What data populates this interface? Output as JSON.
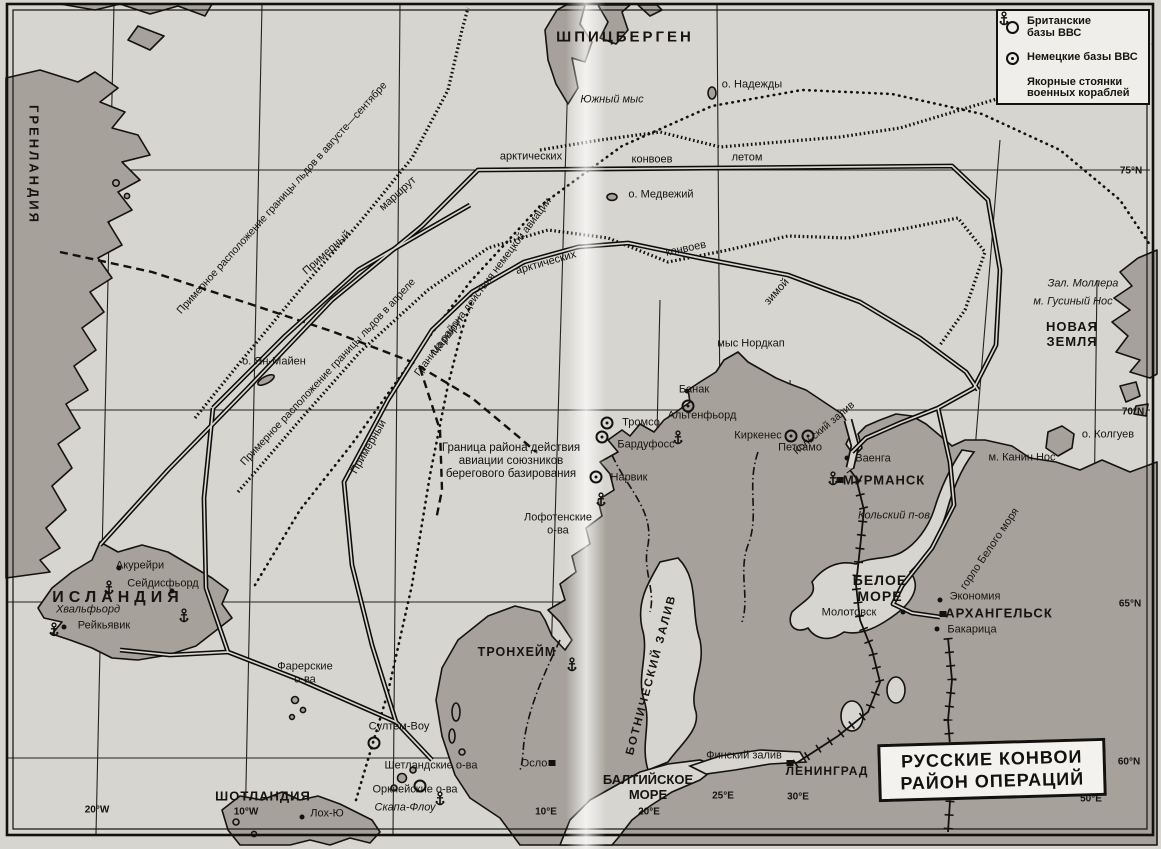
{
  "map": {
    "title_box": {
      "line1": "РУССКИЕ КОНВОИ",
      "line2": "РАЙОН ОПЕРАЦИЙ"
    },
    "legend": {
      "items": [
        {
          "name": "legend-british-bases",
          "symbol": "british-base-icon",
          "label": "Британские\nбазы ВВС"
        },
        {
          "name": "legend-german-bases",
          "symbol": "german-base-icon",
          "label": "Немецкие базы ВВС"
        },
        {
          "name": "legend-anchorages",
          "symbol": "anchor-icon",
          "label": "Якорные стоянки\nвоенных кораблей"
        }
      ]
    },
    "colors": {
      "sea": "#d7d5d0",
      "land": "#a6a29b",
      "ink": "#131110",
      "box_bg": "#f3f2ee"
    },
    "graticule": [
      {
        "name": "lat-75n",
        "text": "75°N",
        "x": 1131,
        "y": 171
      },
      {
        "name": "lat-70n",
        "text": "70°N",
        "x": 1133,
        "y": 412
      },
      {
        "name": "lat-65n",
        "text": "65°N",
        "x": 1130,
        "y": 604
      },
      {
        "name": "lat-60n",
        "text": "60°N",
        "x": 1129,
        "y": 762
      },
      {
        "name": "lon-20w",
        "text": "20°W",
        "x": 97,
        "y": 810
      },
      {
        "name": "lon-10w",
        "text": "10°W",
        "x": 246,
        "y": 812
      },
      {
        "name": "lon-10e",
        "text": "10°E",
        "x": 546,
        "y": 812
      },
      {
        "name": "lon-20e",
        "text": "20°E",
        "x": 649,
        "y": 812
      },
      {
        "name": "lon-25e",
        "text": "25°E",
        "x": 723,
        "y": 796
      },
      {
        "name": "lon-30e",
        "text": "30°E",
        "x": 798,
        "y": 797
      },
      {
        "name": "lon-40e",
        "text": "40°E",
        "x": 944,
        "y": 797
      },
      {
        "name": "lon-50e",
        "text": "50°E",
        "x": 1091,
        "y": 799
      }
    ],
    "labels": [
      {
        "name": "greenland",
        "text": "ГРЕНЛАНДИЯ",
        "x": 33,
        "y": 165,
        "rot": 90,
        "cls": "region",
        "size": 13,
        "sp": 3
      },
      {
        "name": "spitsbergen",
        "text": "ШПИЦБЕРГЕН",
        "x": 625,
        "y": 37,
        "cls": "region",
        "size": 15,
        "sp": 3
      },
      {
        "name": "iceland",
        "text": "ИСЛАНДИЯ",
        "x": 118,
        "y": 598,
        "cls": "region",
        "size": 16,
        "sp": 5
      },
      {
        "name": "novaya-zemlya",
        "text": "НОВАЯ\nЗЕМЛЯ",
        "x": 1072,
        "y": 335,
        "cls": "region",
        "size": 13,
        "sp": 1
      },
      {
        "name": "white-sea",
        "text": "БЕЛОЕ\nМОРЕ",
        "x": 880,
        "y": 588,
        "cls": "region",
        "size": 14,
        "sp": 1
      },
      {
        "name": "baltic-sea",
        "text": "БАЛТИЙСКОЕ\nМОРЕ",
        "x": 648,
        "y": 788,
        "cls": "region",
        "size": 13
      },
      {
        "name": "scotland",
        "text": "ШОТЛАНДИЯ",
        "x": 263,
        "y": 797,
        "cls": "region",
        "size": 13,
        "sp": 1
      },
      {
        "name": "gulf-of-bothnia",
        "text": "БОТНИЧЕСКИЙ ЗАЛИВ",
        "x": 652,
        "y": 675,
        "rot": -75,
        "cls": "region",
        "size": 11.5,
        "sp": 2
      },
      {
        "name": "murmansk",
        "text": "МУРМАНСК",
        "x": 884,
        "y": 481,
        "cls": "city-major",
        "size": 13
      },
      {
        "name": "arkhangelsk",
        "text": "АРХАНГЕЛЬСК",
        "x": 999,
        "y": 614,
        "cls": "city-major",
        "size": 13
      },
      {
        "name": "leningrad",
        "text": "ЛЕНИНГРАД",
        "x": 827,
        "y": 772,
        "cls": "city-major",
        "size": 12
      },
      {
        "name": "trondheim",
        "text": "ТРОНХЕЙМ",
        "x": 517,
        "y": 652,
        "cls": "city-major",
        "size": 12.5
      },
      {
        "name": "akureyri",
        "text": "Акурейри",
        "x": 140,
        "y": 566
      },
      {
        "name": "seydisfjord",
        "text": "Сейдисфьорд",
        "x": 163,
        "y": 584
      },
      {
        "name": "reykjavik",
        "text": "Рейкьявик",
        "x": 104,
        "y": 626
      },
      {
        "name": "hvalfjord",
        "text": "Хвальфьорд",
        "x": 88,
        "y": 610,
        "cls": "italic"
      },
      {
        "name": "tromso",
        "text": "Тромсо",
        "x": 641,
        "y": 423
      },
      {
        "name": "bardufoss",
        "text": "Бардуфосс",
        "x": 646,
        "y": 445
      },
      {
        "name": "banak",
        "text": "Банак",
        "x": 694,
        "y": 390
      },
      {
        "name": "altenfjord",
        "text": "Альтенфьорд",
        "x": 702,
        "y": 416
      },
      {
        "name": "nordkap",
        "text": "мыс Нордкап",
        "x": 751,
        "y": 344
      },
      {
        "name": "kirkenes",
        "text": "Киркенес",
        "x": 758,
        "y": 436
      },
      {
        "name": "petsamo",
        "text": "Петсамо",
        "x": 800,
        "y": 448
      },
      {
        "name": "vaenga",
        "text": "Ваенга",
        "x": 873,
        "y": 459
      },
      {
        "name": "narvik",
        "text": "Нарвик",
        "x": 629,
        "y": 478
      },
      {
        "name": "lofoten",
        "text": "Лофотенские\nо-ва",
        "x": 558,
        "y": 524
      },
      {
        "name": "oslo",
        "text": "Осло",
        "x": 534,
        "y": 764
      },
      {
        "name": "molotovsk",
        "text": "Молотовск",
        "x": 849,
        "y": 613
      },
      {
        "name": "ekonomiya",
        "text": "Экономия",
        "x": 975,
        "y": 597
      },
      {
        "name": "bakaritsa",
        "text": "Бакарица",
        "x": 972,
        "y": 630
      },
      {
        "name": "finnish-gulf",
        "text": "Финский залив",
        "x": 744,
        "y": 756
      },
      {
        "name": "kanin-nos",
        "text": "м. Канин Нос",
        "x": 1022,
        "y": 458
      },
      {
        "name": "kolguev",
        "text": "о. Колгуев",
        "x": 1108,
        "y": 435
      },
      {
        "name": "mollera-bay",
        "text": "Зал. Моллера",
        "x": 1083,
        "y": 284,
        "cls": "italic"
      },
      {
        "name": "gusiny-nos",
        "text": "м. Гусиный Нос",
        "x": 1073,
        "y": 302,
        "cls": "italic"
      },
      {
        "name": "nadezhdy-island",
        "text": "о. Надежды",
        "x": 752,
        "y": 85
      },
      {
        "name": "yuzhny-mys",
        "text": "Южный мыс",
        "x": 612,
        "y": 100,
        "cls": "italic"
      },
      {
        "name": "medvezhy-island",
        "text": "о. Медвежий",
        "x": 661,
        "y": 195
      },
      {
        "name": "yan-mayen",
        "text": "о. Ян-Майен",
        "x": 274,
        "y": 362
      },
      {
        "name": "kolsky-zaliv",
        "text": "Кольский залив",
        "x": 824,
        "y": 428,
        "rot": -40,
        "size": 10.5
      },
      {
        "name": "kolsky-poluostrov",
        "text": "Кольский п-ов",
        "x": 894,
        "y": 516,
        "cls": "italic"
      },
      {
        "name": "gorlo-belogo-morya",
        "text": "горло Белого моря",
        "x": 990,
        "y": 549,
        "rot": -56
      },
      {
        "name": "faroe",
        "text": "Фарерские\nо-ва",
        "x": 305,
        "y": 673
      },
      {
        "name": "sullom-voe",
        "text": "Султем-Воу",
        "x": 399,
        "y": 727
      },
      {
        "name": "shetland",
        "text": "Шетландские о-ва",
        "x": 431,
        "y": 766
      },
      {
        "name": "orkney",
        "text": "Оркнейские о-ва",
        "x": 415,
        "y": 790
      },
      {
        "name": "scapa-flow",
        "text": "Скапа-Флоу",
        "x": 405,
        "y": 808,
        "cls": "italic"
      },
      {
        "name": "loch-ewe",
        "text": "Лох-Ю",
        "x": 327,
        "y": 814
      },
      {
        "name": "ice-border-aug-sep",
        "text": "Примерное расположение границы льдов в августе—сентябре",
        "x": 282,
        "y": 198,
        "rot": -48,
        "cls": "route",
        "size": 10.5
      },
      {
        "name": "route-primerny-1",
        "text": "Примерный",
        "x": 327,
        "y": 253,
        "rot": -42,
        "cls": "route"
      },
      {
        "name": "route-marshrut-1",
        "text": "маршрут",
        "x": 398,
        "y": 194,
        "rot": -42,
        "cls": "route"
      },
      {
        "name": "route-arctic-1",
        "text": "арктических",
        "x": 531,
        "y": 157,
        "cls": "route"
      },
      {
        "name": "route-convoys-1",
        "text": "конвоев",
        "x": 652,
        "y": 160,
        "cls": "route"
      },
      {
        "name": "route-letom",
        "text": "летом",
        "x": 747,
        "y": 158,
        "cls": "route"
      },
      {
        "name": "ice-border-april",
        "text": "Примерное расположение границы льдов в апреле",
        "x": 328,
        "y": 372,
        "rot": -47,
        "cls": "route",
        "size": 10.5
      },
      {
        "name": "german-aviation-boundary",
        "text": "Граница района действия немецкой авиации",
        "x": 483,
        "y": 287,
        "rot": -53,
        "cls": "route",
        "size": 10.5
      },
      {
        "name": "route-marshrut-2",
        "text": "Маршрут",
        "x": 448,
        "y": 336,
        "rot": -52,
        "cls": "route"
      },
      {
        "name": "route-arctic-2",
        "text": "арктических",
        "x": 546,
        "y": 263,
        "rot": -16,
        "cls": "route"
      },
      {
        "name": "route-convoys-2",
        "text": "конвоев",
        "x": 686,
        "y": 249,
        "rot": -12,
        "cls": "route"
      },
      {
        "name": "route-zimoy",
        "text": "зимой",
        "x": 777,
        "y": 292,
        "rot": -48,
        "cls": "route"
      },
      {
        "name": "route-primerny-2",
        "text": "Примерный",
        "x": 369,
        "y": 447,
        "rot": -60,
        "cls": "route"
      },
      {
        "name": "allied-aviation-boundary",
        "text": "Граница района действия\nавиации союзников\nберегового базирования",
        "x": 511,
        "y": 462,
        "cls": "route",
        "size": 11.5
      }
    ],
    "markers": {
      "german_bases": [
        {
          "x": 607,
          "y": 423
        },
        {
          "x": 602,
          "y": 437
        },
        {
          "x": 688,
          "y": 406
        },
        {
          "x": 791,
          "y": 436
        },
        {
          "x": 808,
          "y": 436
        },
        {
          "x": 596,
          "y": 477
        }
      ],
      "british_bases": [
        {
          "x": 374,
          "y": 743
        },
        {
          "x": 420,
          "y": 786
        }
      ],
      "anchors": [
        {
          "x": 48,
          "y": 622
        },
        {
          "x": 103,
          "y": 580
        },
        {
          "x": 178,
          "y": 608
        },
        {
          "x": 827,
          "y": 471
        },
        {
          "x": 672,
          "y": 430
        },
        {
          "x": 566,
          "y": 657
        },
        {
          "x": 434,
          "y": 791
        },
        {
          "x": 595,
          "y": 492
        }
      ],
      "town_dots": [
        {
          "x": 119,
          "y": 568
        },
        {
          "x": 172,
          "y": 591
        },
        {
          "x": 64,
          "y": 627
        },
        {
          "x": 847,
          "y": 458
        },
        {
          "x": 940,
          "y": 600
        },
        {
          "x": 937,
          "y": 629
        },
        {
          "x": 903,
          "y": 612
        },
        {
          "x": 302,
          "y": 817
        },
        {
          "x": 687,
          "y": 391
        }
      ],
      "city_squares": [
        {
          "x": 840,
          "y": 480
        },
        {
          "x": 943,
          "y": 614
        },
        {
          "x": 790,
          "y": 763
        },
        {
          "x": 552,
          "y": 763
        }
      ]
    }
  }
}
